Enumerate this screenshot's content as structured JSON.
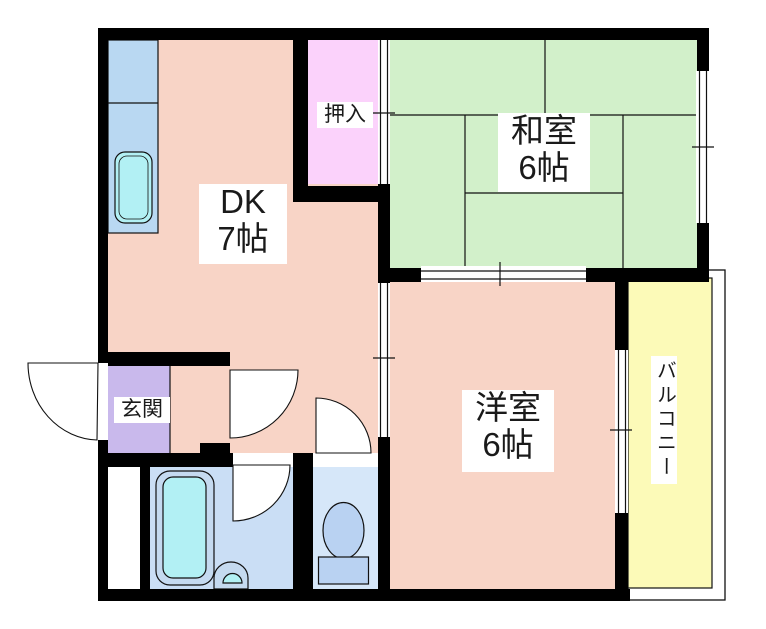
{
  "rooms": {
    "dk": {
      "name": "DK",
      "size": "7帖"
    },
    "washitsu": {
      "name": "和室",
      "size": "6帖"
    },
    "yoshitsu": {
      "name": "洋室",
      "size": "6帖"
    },
    "oshiire": {
      "name": "押入"
    },
    "genkan": {
      "name": "玄関"
    },
    "balcony": {
      "name": "バルコニー"
    }
  },
  "colors": {
    "wall": "#000000",
    "line": "#111111",
    "dk": "#f8d4c6",
    "washitsu": "#d2f0ca",
    "yoshitsu": "#f8d4c6",
    "oshiire": "#fbd2fb",
    "genkan": "#c9b9ec",
    "balcony": "#fcfab8",
    "counter": "#b9d8f2",
    "bath": "#cadef5",
    "toilet_room": "#d6e7f9",
    "fixture_cyan": "#b2f0f4",
    "fixture_blue": "#c5daf0",
    "toilet_fixture": "#b9d2f2",
    "white": "#ffffff"
  }
}
